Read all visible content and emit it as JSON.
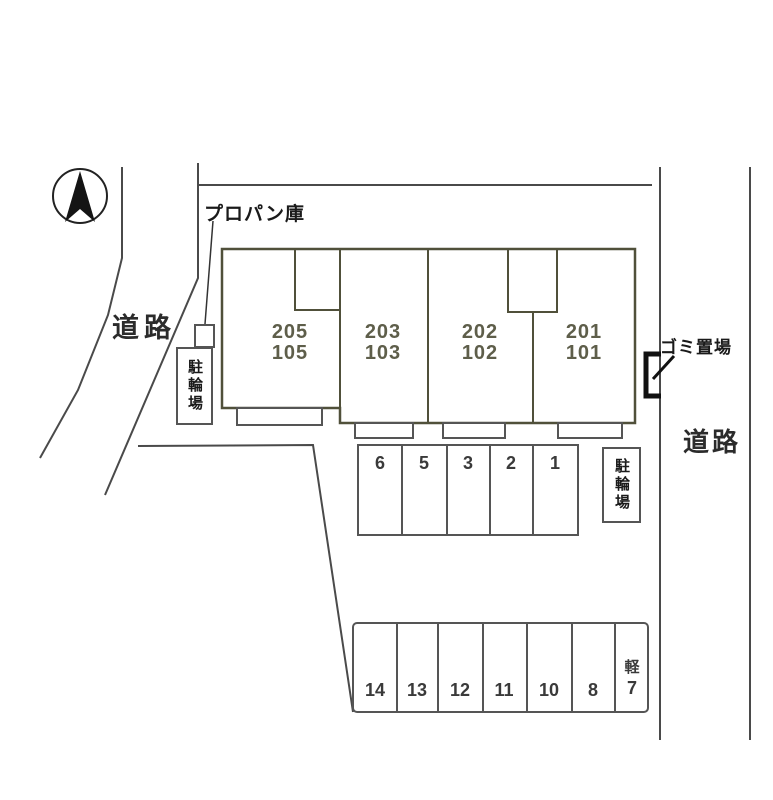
{
  "plan": {
    "labels": {
      "propane": "プロパン庫",
      "road_left": "道路",
      "road_right": "道路",
      "garbage": "ゴミ置場",
      "bicycle_left": "駐輪場",
      "bicycle_right": "駐輪場"
    },
    "building": {
      "units": [
        {
          "upper": "205",
          "lower": "105"
        },
        {
          "upper": "203",
          "lower": "103"
        },
        {
          "upper": "202",
          "lower": "102"
        },
        {
          "upper": "201",
          "lower": "101"
        }
      ]
    },
    "parking": {
      "middle_row": [
        "6",
        "5",
        "3",
        "2",
        "1"
      ],
      "bottom_row": [
        "14",
        "13",
        "12",
        "11",
        "10",
        "8"
      ],
      "kei_space": {
        "upper": "軽",
        "lower": "7"
      }
    },
    "icons": {
      "compass": "north-arrow-compass",
      "garbage_enclosure": "bracket-enclosure"
    },
    "colors": {
      "building_fill": "#f6f6c2",
      "building_stroke": "#50503a",
      "unit_text": "#5e5e4a",
      "boundary_line": "#4a4a4a",
      "parking_stroke": "#555555",
      "text": "#1a1a1a"
    }
  }
}
